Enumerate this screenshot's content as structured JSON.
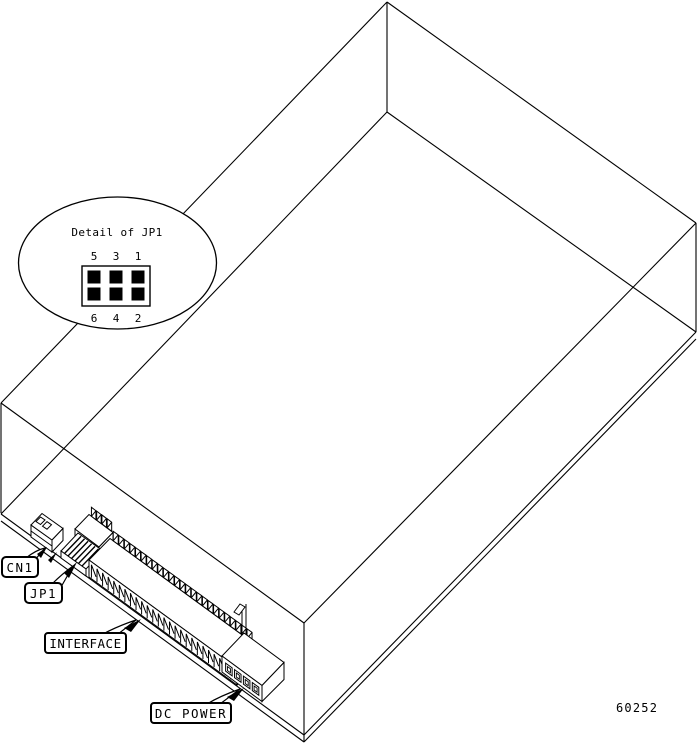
{
  "diagram": {
    "detail_callout": {
      "title": "Detail of JP1",
      "pin_numbers_top": [
        "5",
        "3",
        "1"
      ],
      "pin_numbers_bottom": [
        "6",
        "4",
        "2"
      ]
    },
    "component_labels": {
      "cn1": "CN1",
      "jp1": "JP1",
      "interface": "INTERFACE",
      "dc_power": "DC POWER"
    },
    "figure_number": "60252",
    "colors": {
      "line": "#000000",
      "background": "#ffffff"
    }
  }
}
